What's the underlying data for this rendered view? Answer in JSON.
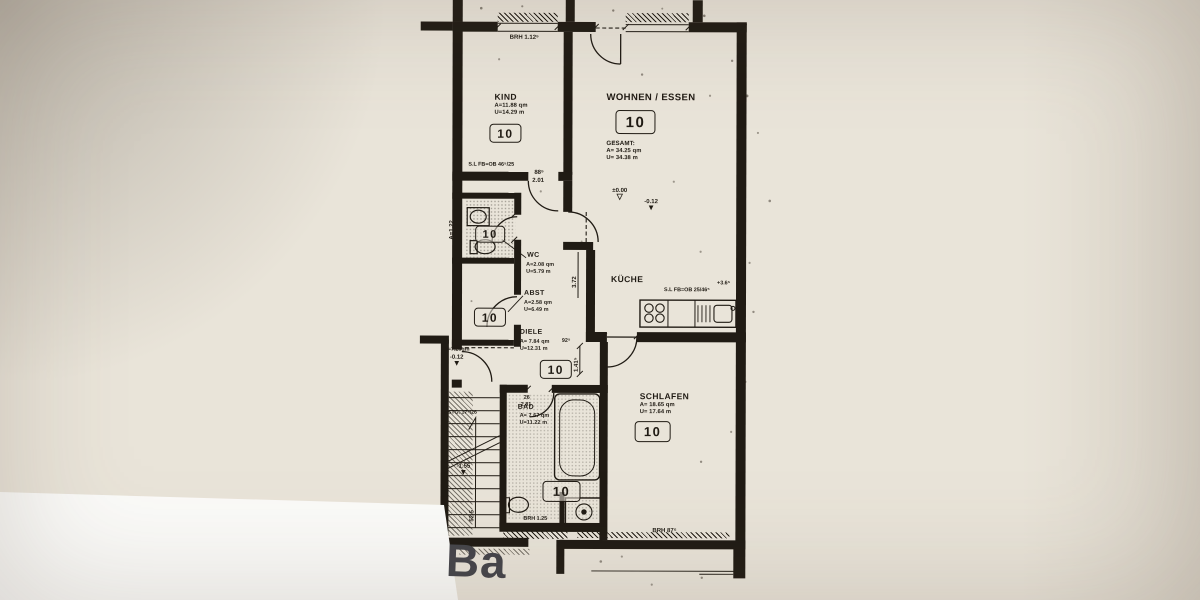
{
  "colors": {
    "paper": "#e9e4d9",
    "ink": "#201b14",
    "corner_label_gray": "#45454b"
  },
  "icons": {
    "level_marker_filled": "▼",
    "level_marker_open": "▽"
  },
  "page": {
    "corner_label": "Ba"
  },
  "rooms": {
    "kind": {
      "name": "KIND",
      "area": "A=11.88 qm",
      "perimeter": "U=14.29 m",
      "unit": "10"
    },
    "wohnen": {
      "name": "WOHNEN / ESSEN",
      "unit": "10",
      "gesamt_title": "GESAMT:",
      "gesamt_area": "A= 34.25 qm",
      "gesamt_perimeter": "U= 34.38 m"
    },
    "wc": {
      "name": "WC",
      "area": "A=2.08 qm",
      "perimeter": "U=5.79 m",
      "unit": "10"
    },
    "abst": {
      "name": "ABST",
      "area": "A=2.58 qm",
      "perimeter": "U=6.49 m",
      "unit": "10"
    },
    "diele": {
      "name": "DIELE",
      "area": "A= 7.84 qm",
      "perimeter": "U=12.31 m",
      "unit": "10"
    },
    "kueche": {
      "name": "KÜCHE"
    },
    "schlafen": {
      "name": "SCHLAFEN",
      "area": "A= 18.65 qm",
      "perimeter": "U= 17.64 m",
      "unit": "10"
    },
    "bad": {
      "name": "BAD",
      "area": "A= 7.67 qm",
      "perimeter": "U=11.22 m",
      "unit": "10"
    }
  },
  "levels": {
    "wohnen_zero": "±0.00",
    "wohnen_minus": "-0.12",
    "landing_minus": "-0.12",
    "stair_minus": "-1.55"
  },
  "annotations": {
    "brh_window_top": "BRH 1.12⁵",
    "sl_fb_kind": "S.L FB=OB 46⁵/25",
    "sl_fb_kueche": "S.L FB=OB 25/46⁵",
    "plus_365": "+3.6⁵",
    "dim_372": "3.72",
    "dim_885": "88⁵",
    "dim_201": "2.01",
    "dim_925": "92⁵",
    "dim_1415": "1.41⁵",
    "dim_26": "26",
    "dim_281": "2.81",
    "dim_52sup": "52⁵",
    "dim_525": "52.5",
    "stairs_note": "17 STG. 17⁹/26",
    "landing_area": "A=7.20qm",
    "dim_a122": "A=1.22",
    "brh_875": "BRH 87⁵",
    "brh_125": "BRH 1.25"
  }
}
